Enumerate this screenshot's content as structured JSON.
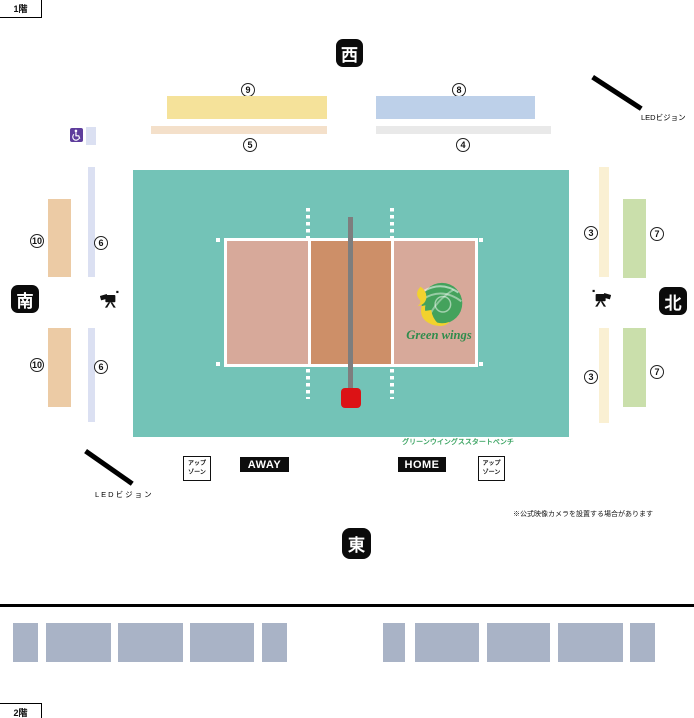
{
  "floors": {
    "floor1": "1階",
    "floor2": "2階"
  },
  "compass": {
    "west": "西",
    "east": "東",
    "south": "南",
    "north": "北"
  },
  "sections": {
    "s3": "3",
    "s4": "4",
    "s5": "5",
    "s6": "6",
    "s7": "7",
    "s8": "8",
    "s9": "9",
    "s10": "10"
  },
  "labels": {
    "led_vision": "LEDビジョン",
    "bench": "グリーンウイングススタートベンチ",
    "camera_note": "※公式映像カメラを設置する場合があります",
    "away": "AWAY",
    "home": "HOME",
    "up_zone_line1": "アップ",
    "up_zone_line2": "ゾーン"
  },
  "team": {
    "name": "Green wings"
  },
  "colors": {
    "court_floor": "#73C3B7",
    "court_side_zone": "#D7A99A",
    "court_center_zone": "#CD8F68",
    "net": "#7E7E7E",
    "referee_stand_red": "#DC1215",
    "section3_cream": "#FAF0D3",
    "section4_gray": "#E9E9E9",
    "section5_peach": "#F4E0CA",
    "section6_lavender": "#DBE0F2",
    "section7_green": "#CADFAB",
    "section8_blue": "#BDD0E9",
    "section9_yellow": "#F5E29A",
    "section10_tan": "#ECCBA5",
    "floor2_seat_gray": "#A9B3C6",
    "wheelchair_purple": "#5E3D9C",
    "bench_text_green": "#3CA463"
  }
}
